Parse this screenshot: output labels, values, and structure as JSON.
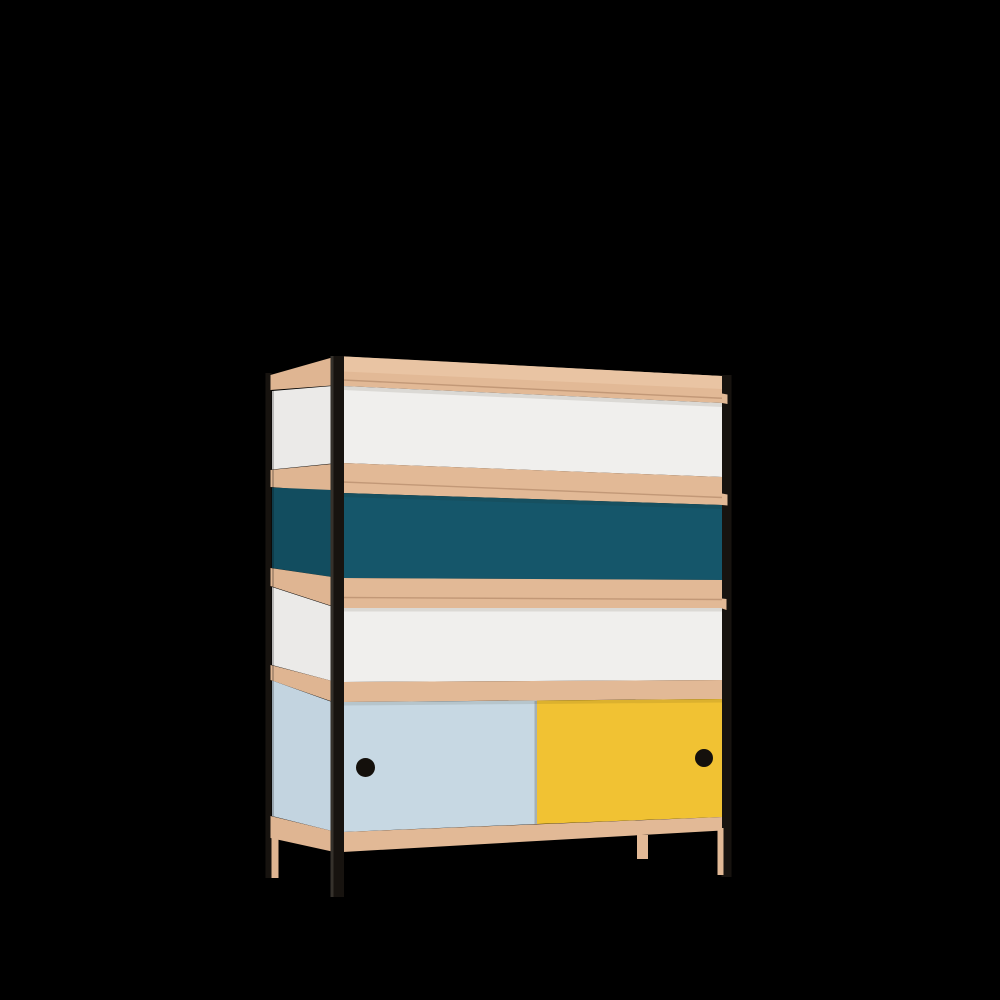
{
  "scene": {
    "type": "product-render",
    "description": "3D render of a modernist storage cabinet / shelving unit on a black background, viewed from the front-left. Four rows: white panel, dark teal panel, white panel, and a bottom cupboard with a light-blue and a yellow sliding door, each with a round black finger-hole handle. Tan wooden shelves and rails, thin black metal corner posts and wooden legs.",
    "background_label": "black backdrop"
  },
  "object": {
    "name": "colour-block storage cabinet",
    "rows": [
      {
        "label": "top shelf row",
        "panel": "white"
      },
      {
        "label": "second row",
        "panel": "dark teal"
      },
      {
        "label": "third row",
        "panel": "white"
      },
      {
        "label": "cupboard row",
        "panel_left": "light blue sliding door",
        "panel_right": "yellow sliding door"
      }
    ],
    "doors": {
      "left_door": {
        "color_name": "light blue",
        "handle": "black round finger hole"
      },
      "right_door": {
        "color_name": "yellow",
        "handle": "black round finger hole"
      }
    },
    "frame": {
      "posts": "black metal round posts (front-left, rear-left, front-right)",
      "legs": "tan wooden legs (rear-left, centre-front, front-right)",
      "shelves": "tan wood shelf bands with protruding front rails"
    }
  },
  "colors": {
    "background": "#000000",
    "wood_top": "#e9c4a3",
    "wood_front": "#e2b996",
    "wood_side": "#dfb592",
    "wood_seam": "#a87e5e",
    "panel_white_front": "#f0efed",
    "panel_white_side": "#ebeae8",
    "panel_teal_front": "#15566a",
    "panel_teal_side": "#124d5f",
    "door_blue": "#c7d8e3",
    "door_blue_side": "#c3d4e0",
    "door_yellow": "#f1c233",
    "frame_black": "#17130f",
    "post_highlight": "#35312b",
    "handle_black": "#14100c",
    "shadow_soft": "rgba(40,25,10,0.10)",
    "shadow_edge": "rgba(0,0,0,0.22)",
    "divider_shadow": "rgba(30,20,5,0.20)"
  }
}
